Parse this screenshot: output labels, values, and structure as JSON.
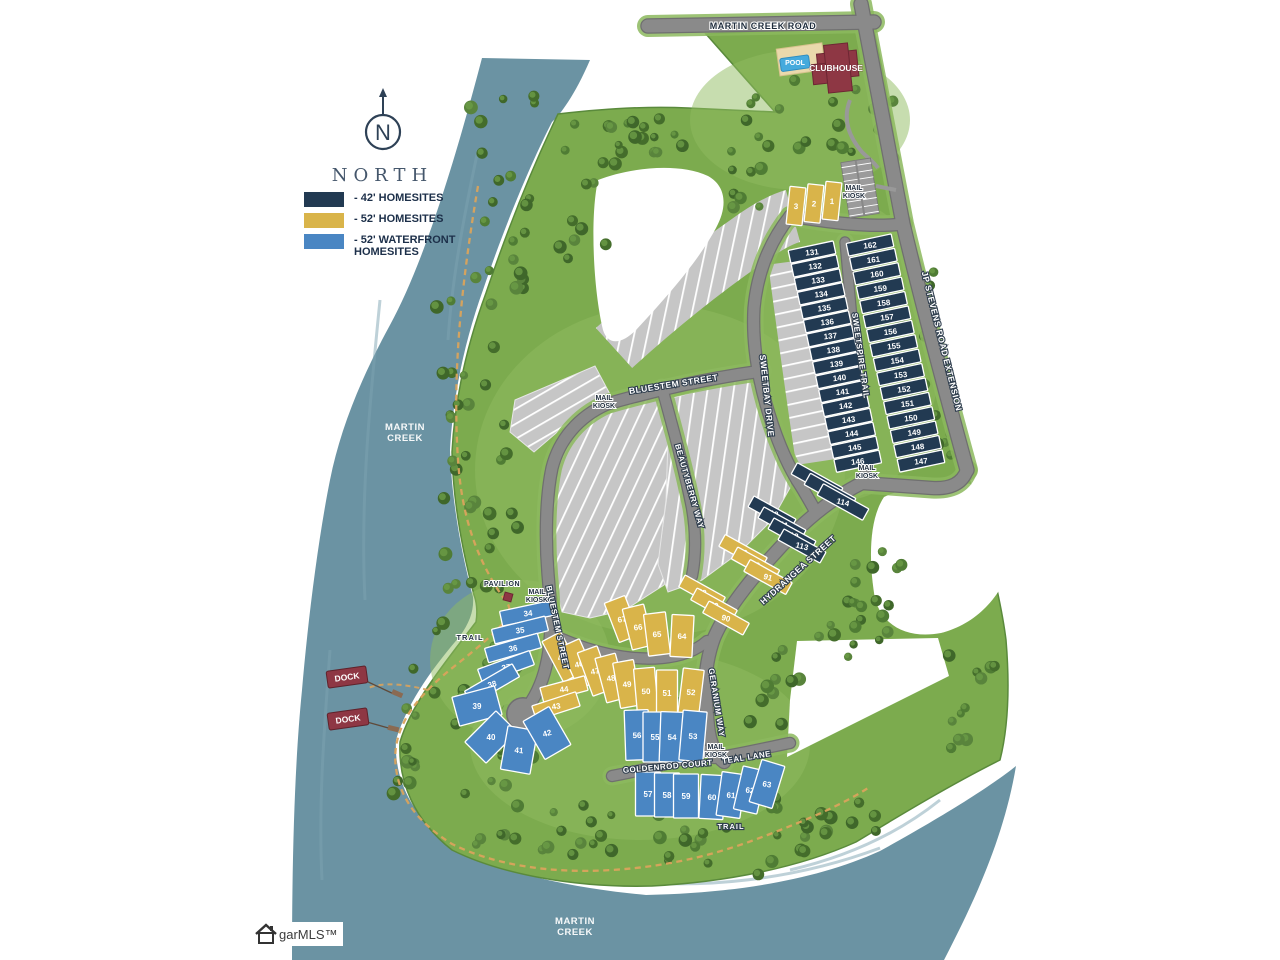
{
  "colors": {
    "navy": "#223a52",
    "gold": "#d9b44a",
    "blue": "#4a86c3",
    "water": "#6b93a3",
    "land": "#7cab4e",
    "road": "#8a8a8a",
    "gray_lot": "#c6c6c6",
    "red": "#8e3744",
    "trail": "#daa35c"
  },
  "compass": {
    "label": "NORTH"
  },
  "legend": {
    "items": [
      {
        "swatch": "navy",
        "label": "- 42' HOMESITES"
      },
      {
        "swatch": "gold",
        "label": "- 52' HOMESITES"
      },
      {
        "swatch": "blue",
        "label": "- 52' WATERFRONT HOMESITES"
      }
    ]
  },
  "streets": [
    {
      "name": "MARTIN CREEK ROAD",
      "x": 763,
      "y": 29,
      "rot": 0,
      "style": "dark",
      "size": 9
    },
    {
      "name": "JP STEVENS ROAD EXTENSION",
      "x": 939,
      "y": 342,
      "rot": 76,
      "style": "light",
      "size": 8.5
    },
    {
      "name": "SWEETSPIRE TRAIL",
      "x": 858,
      "y": 356,
      "rot": 82,
      "style": "light",
      "size": 8
    },
    {
      "name": "SWEETBAY DRIVE",
      "x": 764,
      "y": 396,
      "rot": 84,
      "style": "light",
      "size": 8.5
    },
    {
      "name": "BLUESTEM STREET",
      "x": 674,
      "y": 387,
      "rot": -9,
      "style": "light",
      "size": 8.5
    },
    {
      "name": "BLUESTEM STREET",
      "x": 555,
      "y": 628,
      "rot": 78,
      "style": "light",
      "size": 8
    },
    {
      "name": "BEAUTYBERRY WAY",
      "x": 687,
      "y": 487,
      "rot": 74,
      "style": "light",
      "size": 8
    },
    {
      "name": "HYDRANGEA STREET",
      "x": 800,
      "y": 572,
      "rot": -42,
      "style": "light",
      "size": 8.5
    },
    {
      "name": "GERANIUM WAY",
      "x": 714,
      "y": 703,
      "rot": 81,
      "style": "light",
      "size": 8
    },
    {
      "name": "GOLDENROD COURT",
      "x": 668,
      "y": 769,
      "rot": -5,
      "style": "light",
      "size": 8
    },
    {
      "name": "TEAL LANE",
      "x": 747,
      "y": 760,
      "rot": -9,
      "style": "light",
      "size": 8
    }
  ],
  "mail_kiosk": {
    "lines": [
      "MAIL",
      "KIOSK"
    ],
    "positions": [
      {
        "x": 854,
        "y": 190
      },
      {
        "x": 604,
        "y": 400
      },
      {
        "x": 537,
        "y": 594
      },
      {
        "x": 867,
        "y": 470
      },
      {
        "x": 716,
        "y": 749
      }
    ]
  },
  "pois": {
    "pavilion": {
      "label": "PAVILION",
      "x": 502,
      "y": 586
    },
    "trail_labels": [
      {
        "label": "TRAIL",
        "x": 470,
        "y": 640,
        "style": "dark"
      },
      {
        "label": "TRAIL",
        "x": 731,
        "y": 829,
        "style": "light"
      }
    ],
    "water_labels": [
      {
        "lines": [
          "MARTIN",
          "CREEK"
        ],
        "x": 405,
        "y": 430
      },
      {
        "lines": [
          "MARTIN",
          "CREEK"
        ],
        "x": 575,
        "y": 924
      }
    ],
    "pool": {
      "label": "POOL",
      "x": 795,
      "y": 65
    },
    "clubhouse": {
      "label": "CLUBHOUSE",
      "x": 836,
      "y": 71
    },
    "docks": {
      "label": "DOCK",
      "positions": [
        {
          "x": 347,
          "y": 677
        },
        {
          "x": 348,
          "y": 719
        }
      ]
    }
  },
  "lot_groups": [
    {
      "id": "g-1-3",
      "type": "gold",
      "layout": "row",
      "start": [
        796,
        206
      ],
      "step": [
        18,
        -2.5
      ],
      "w": 16,
      "h": 38,
      "angle": 6,
      "lots": [
        "3",
        "2",
        "1"
      ]
    },
    {
      "id": "g-131-146",
      "type": "navy",
      "layout": "row",
      "start": [
        812,
        252
      ],
      "step": [
        3.05,
        13.95
      ],
      "w": 46,
      "h": 13,
      "angle": -12,
      "lots": [
        "131",
        "132",
        "133",
        "134",
        "135",
        "136",
        "137",
        "138",
        "139",
        "140",
        "141",
        "142",
        "143",
        "144",
        "145",
        "146"
      ]
    },
    {
      "id": "g-162-147",
      "type": "navy",
      "layout": "row",
      "start": [
        870,
        245
      ],
      "step": [
        3.4,
        14.4
      ],
      "w": 46,
      "h": 13,
      "angle": -12,
      "lots": [
        "162",
        "161",
        "160",
        "159",
        "158",
        "157",
        "156",
        "155",
        "154",
        "153",
        "152",
        "151",
        "150",
        "149",
        "148",
        "147"
      ]
    },
    {
      "id": "g-116-114",
      "type": "navy",
      "layout": "row",
      "start": [
        817,
        481
      ],
      "step": [
        13,
        10.5
      ],
      "w": 52,
      "h": 13,
      "angle": 29,
      "lots": [
        "116",
        "115",
        "114"
      ]
    },
    {
      "id": "g-110-113",
      "type": "navy",
      "layout": "row",
      "start": [
        772,
        513
      ],
      "step": [
        10,
        11
      ],
      "w": 48,
      "h": 12.5,
      "angle": 29,
      "lots": [
        "110",
        "111",
        "112",
        "113"
      ]
    },
    {
      "id": "g-93-91",
      "type": "gold",
      "layout": "row",
      "start": [
        743,
        552
      ],
      "step": [
        12.5,
        12.5
      ],
      "w": 48,
      "h": 13.5,
      "angle": 29,
      "lots": [
        "93",
        "92",
        "91"
      ]
    },
    {
      "id": "g-88-90",
      "type": "gold",
      "layout": "row",
      "start": [
        702,
        592
      ],
      "step": [
        12,
        13
      ],
      "w": 46,
      "h": 13.5,
      "angle": 29,
      "lots": [
        "88",
        "89",
        "90"
      ]
    },
    {
      "id": "g-67-64",
      "type": "gold",
      "layout": "explicit",
      "w": 22,
      "h": 42,
      "lots": [
        {
          "n": "67",
          "x": 622,
          "y": 619,
          "a": -21
        },
        {
          "n": "66",
          "x": 638,
          "y": 627,
          "a": -14
        },
        {
          "n": "65",
          "x": 657,
          "y": 634,
          "a": -7
        },
        {
          "n": "64",
          "x": 682,
          "y": 636,
          "a": 3
        }
      ]
    },
    {
      "id": "g-45-52",
      "type": "gold",
      "layout": "explicit",
      "w": 21,
      "h": 46,
      "lots": [
        {
          "n": "45",
          "x": 562,
          "y": 657,
          "a": -28
        },
        {
          "n": "46",
          "x": 579,
          "y": 664,
          "a": -24
        },
        {
          "n": "47",
          "x": 595,
          "y": 671,
          "a": -20
        },
        {
          "n": "48",
          "x": 611,
          "y": 678,
          "a": -15
        },
        {
          "n": "49",
          "x": 627,
          "y": 684,
          "a": -10
        },
        {
          "n": "50",
          "x": 646,
          "y": 691,
          "a": -5
        },
        {
          "n": "51",
          "x": 667,
          "y": 693,
          "a": 0
        },
        {
          "n": "52",
          "x": 691,
          "y": 692,
          "a": 7
        }
      ]
    },
    {
      "id": "g-44-43",
      "type": "gold",
      "layout": "explicit",
      "w": 46,
      "h": 15,
      "lots": [
        {
          "n": "44",
          "x": 564,
          "y": 689,
          "a": -15
        },
        {
          "n": "43",
          "x": 556,
          "y": 706,
          "a": -18
        }
      ]
    },
    {
      "id": "g-34-38",
      "type": "blue",
      "layout": "explicit",
      "w": 55,
      "h": 15,
      "lots": [
        {
          "n": "34",
          "x": 528,
          "y": 613,
          "a": -12
        },
        {
          "n": "35",
          "x": 520,
          "y": 630,
          "a": -14
        },
        {
          "n": "36",
          "x": 513,
          "y": 648,
          "a": -16
        },
        {
          "n": "37",
          "x": 506,
          "y": 667,
          "a": -20
        },
        {
          "n": "38",
          "x": 492,
          "y": 684,
          "a": -30
        }
      ]
    },
    {
      "id": "g-39-42",
      "type": "blue",
      "layout": "explicit",
      "w": 30,
      "h": 44,
      "lots": [
        {
          "n": "39",
          "x": 477,
          "y": 706,
          "a": 75
        },
        {
          "n": "40",
          "x": 491,
          "y": 737,
          "a": 45
        },
        {
          "n": "41",
          "x": 519,
          "y": 750,
          "a": 10
        },
        {
          "n": "42",
          "x": 547,
          "y": 733,
          "a": -30
        }
      ]
    },
    {
      "id": "g-56-53",
      "type": "blue",
      "layout": "explicit",
      "w": 24,
      "h": 50,
      "lots": [
        {
          "n": "56",
          "x": 637,
          "y": 735,
          "a": -2
        },
        {
          "n": "55",
          "x": 655,
          "y": 737,
          "a": 0
        },
        {
          "n": "54",
          "x": 672,
          "y": 737,
          "a": 2
        },
        {
          "n": "53",
          "x": 693,
          "y": 736,
          "a": 5
        }
      ]
    },
    {
      "id": "g-57-59",
      "type": "blue",
      "layout": "row",
      "start": [
        648,
        794
      ],
      "step": [
        19,
        1
      ],
      "w": 25,
      "h": 44,
      "angle": 0,
      "lots": [
        "57",
        "58",
        "59"
      ]
    },
    {
      "id": "g-60-63",
      "type": "blue",
      "layout": "explicit",
      "w": 24,
      "h": 44,
      "lots": [
        {
          "n": "60",
          "x": 712,
          "y": 797,
          "a": 3
        },
        {
          "n": "61",
          "x": 731,
          "y": 795,
          "a": 8
        },
        {
          "n": "62",
          "x": 750,
          "y": 790,
          "a": 13
        },
        {
          "n": "63",
          "x": 767,
          "y": 784,
          "a": 17
        }
      ]
    }
  ],
  "watermark": "garMLS™"
}
